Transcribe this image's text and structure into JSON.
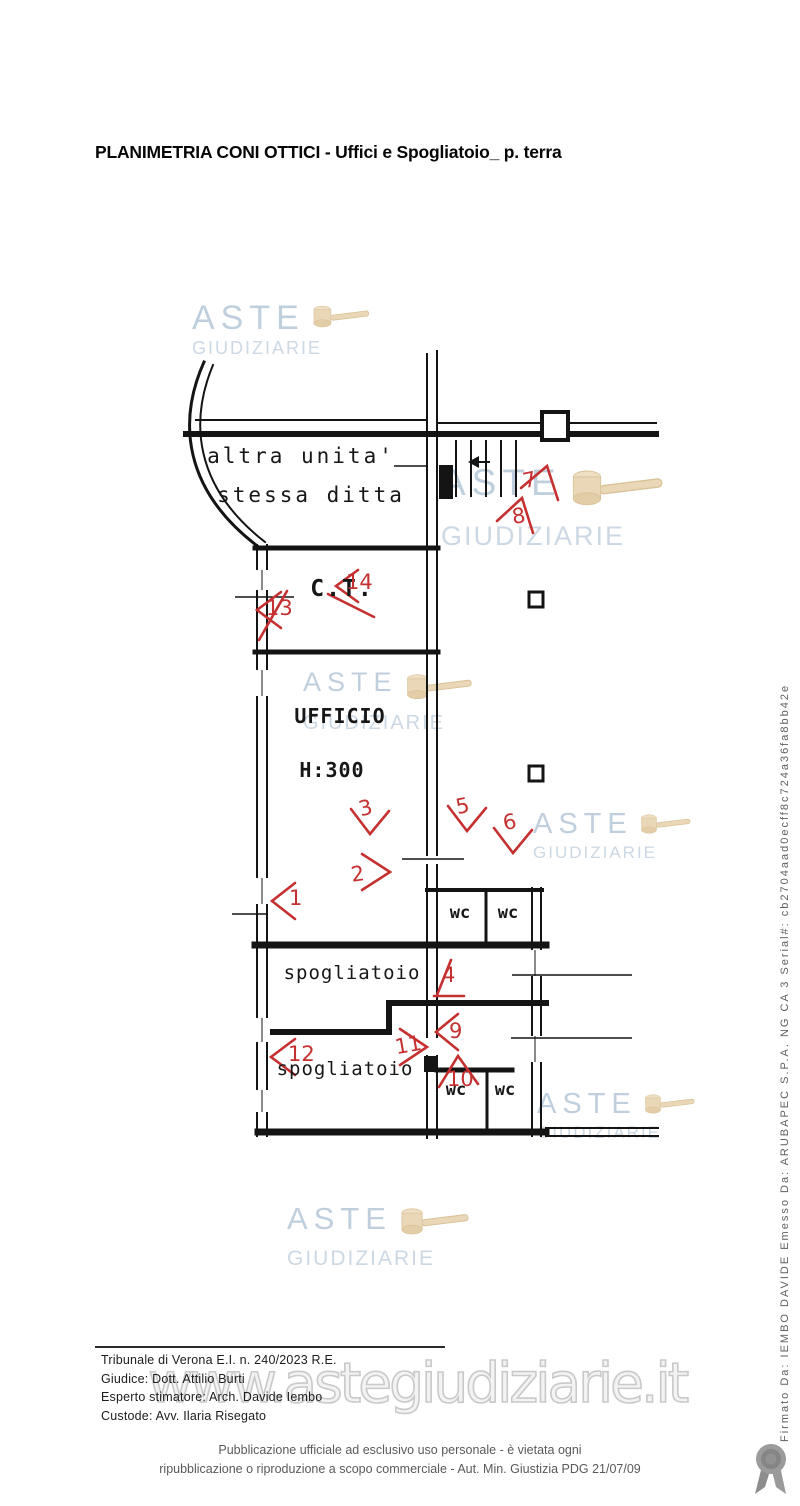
{
  "title": "PLANIMETRIA CONI OTTICI - Uffici e Spogliatoio_ p. terra",
  "plan": {
    "labels": {
      "altra_unita_1": "altra unita'",
      "altra_unita_2": "stessa ditta",
      "ct": "C.T.",
      "ufficio": "UFFICIO",
      "altezza": "H:300",
      "spogliatoio_1": "spogliatoio",
      "spogliatoio_2": "spogliatoio",
      "wc_1": "wc",
      "wc_2": "wc",
      "wc_3": "wc",
      "wc_4": "wc"
    },
    "markers": [
      "1",
      "2",
      "3",
      "4",
      "5",
      "6",
      "7",
      "8",
      "9",
      "10",
      "11",
      "12",
      "13",
      "14"
    ]
  },
  "watermark": {
    "line1": "ASTE",
    "line2": "GIUDIZIARIE",
    "url": "www.astegiudiziarie.it"
  },
  "case_info": {
    "line1": "Tribunale di Verona E.I. n. 240/2023 R.E.",
    "line2": "Giudice: Dott. Attilio Burti",
    "line3": "Esperto stimatore: Arch. Davide Iembo",
    "line4": "Custode: Avv. Ilaria Risegato"
  },
  "footer": {
    "line1": "Pubblicazione ufficiale ad esclusivo uso personale - è vietata ogni",
    "line2": "ripubblicazione o riproduzione a scopo commerciale - Aut. Min. Giustizia PDG 21/07/09"
  },
  "signature": "Firmato Da: IEMBO DAVIDE Emesso Da: ARUBAPEC S.P.A. NG CA 3 Serial#: cb2704aad0ecff8c724a36fa8bb42e",
  "colors": {
    "marker_red": "#c53030",
    "watermark_blue": "#8da8c2",
    "gavel_beige": "#e9d7b8",
    "plan_ink": "#141414"
  }
}
